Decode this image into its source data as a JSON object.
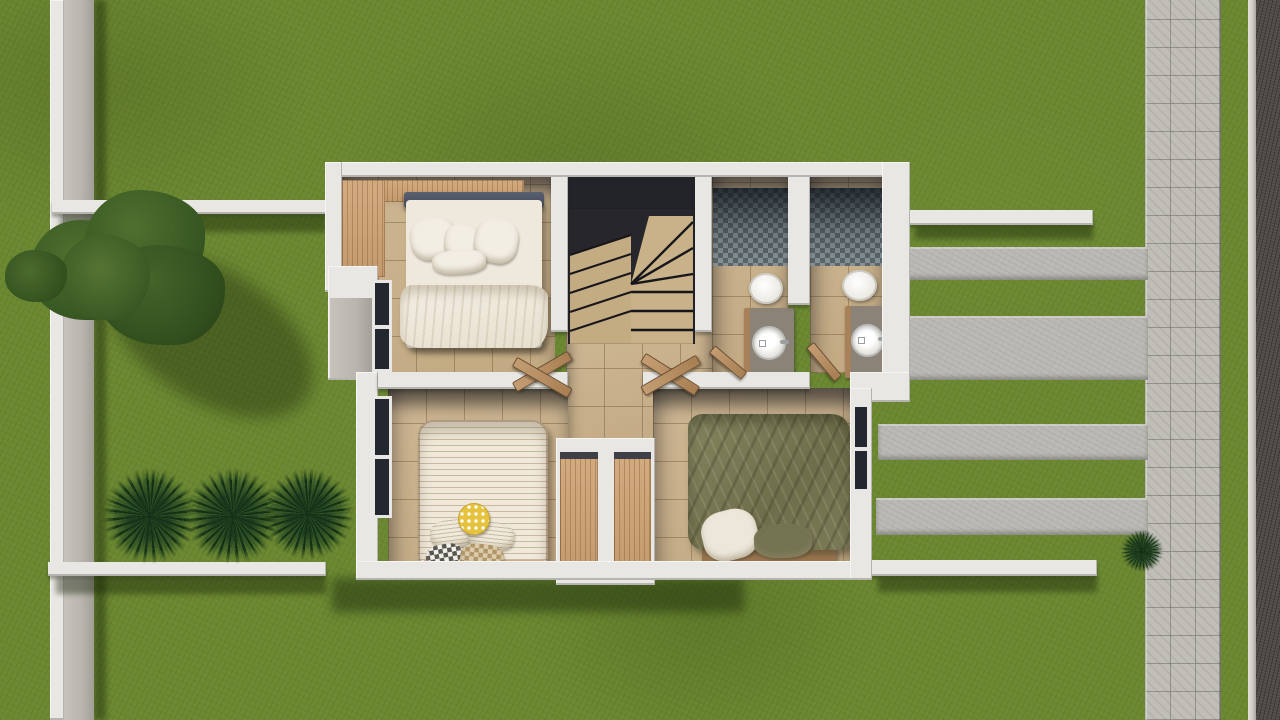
{
  "scene": {
    "description": "Top-down 3D architectural rendering of the upper floor plan of a small house surrounded by a lawn, garden walls, a striped concrete driveway, a paved sidewalk and a street",
    "view": "top-down aerial",
    "style": "photorealistic render",
    "visible_text": "none"
  },
  "colors": {
    "grass-base": "#6d8a33",
    "wall-white": "#e9e7e3",
    "wall-grey": "#b9b5ae",
    "concrete": "#bab8b2",
    "walkway": "#c1beb8",
    "road": "#4e4a46",
    "curb": "#cfccc6",
    "tile": "#c2a982",
    "grout": "rgba(125,100,65,.5)",
    "wood": "#c39a6d",
    "wood-dark": "#a8805a",
    "mosaic-light": "#8e999c",
    "mosaic-dark": "#5f6b70",
    "duvet-olive": "#76764f",
    "bed-white": "#efe9dd",
    "stair-tread": "#c3ab82",
    "stair-void": "#26262b",
    "accent-yellow": "#e5c33e"
  },
  "house": {
    "rooms": [
      {
        "name": "Bedroom 1",
        "position": "top-left",
        "furniture": [
          "L-shaped wooden wardrobe",
          "double bed with white bedding, four pillows and folded duvet"
        ],
        "window": "left wall"
      },
      {
        "name": "Staircase hall",
        "position": "top-center",
        "furniture": [
          "U-shaped winder staircase with tan treads"
        ]
      },
      {
        "name": "Bathroom 1",
        "position": "top-right-inner",
        "furniture": [
          "mosaic tiled shower",
          "wall-hung toilet",
          "vanity with round sink"
        ]
      },
      {
        "name": "Bathroom 2",
        "position": "top-right-outer",
        "furniture": [
          "mosaic tiled shower",
          "wall-hung toilet",
          "vanity with round sink"
        ]
      },
      {
        "name": "Hallway",
        "position": "center",
        "furniture": [
          "open wooden double doors",
          "built-in closet with two wood panels"
        ]
      },
      {
        "name": "Bedroom 2",
        "position": "bottom-left",
        "furniture": [
          "double bed with striped cream duvet, yellow polka-dot round cushion, patterned pillows"
        ],
        "window": "left wall"
      },
      {
        "name": "Bedroom 3",
        "position": "bottom-right",
        "furniture": [
          "double bed with olive green duvet, white and olive pillows, wooden frame"
        ],
        "window": "right wall"
      }
    ]
  },
  "landscape": {
    "items": [
      {
        "name": "large tree with cast shadow",
        "position": "upper-left lawn"
      },
      {
        "name": "small shrub",
        "position": "left boundary"
      },
      {
        "name": "three spiky palm plants",
        "position": "lower-left lawn"
      },
      {
        "name": "small palm plant",
        "position": "right lawn near sidewalk"
      },
      {
        "name": "left boundary wall",
        "orientation": "vertical"
      },
      {
        "name": "garden wall upper-left",
        "orientation": "horizontal"
      },
      {
        "name": "garden wall upper-right",
        "orientation": "horizontal"
      },
      {
        "name": "garden wall lower-left",
        "orientation": "horizontal"
      },
      {
        "name": "garden wall lower-right",
        "orientation": "horizontal"
      }
    ]
  },
  "street": {
    "items": [
      {
        "name": "four concrete driveway strips",
        "position": "right of house"
      },
      {
        "name": "paver sidewalk",
        "orientation": "vertical, right side"
      },
      {
        "name": "asphalt road",
        "position": "far right edge"
      }
    ]
  }
}
